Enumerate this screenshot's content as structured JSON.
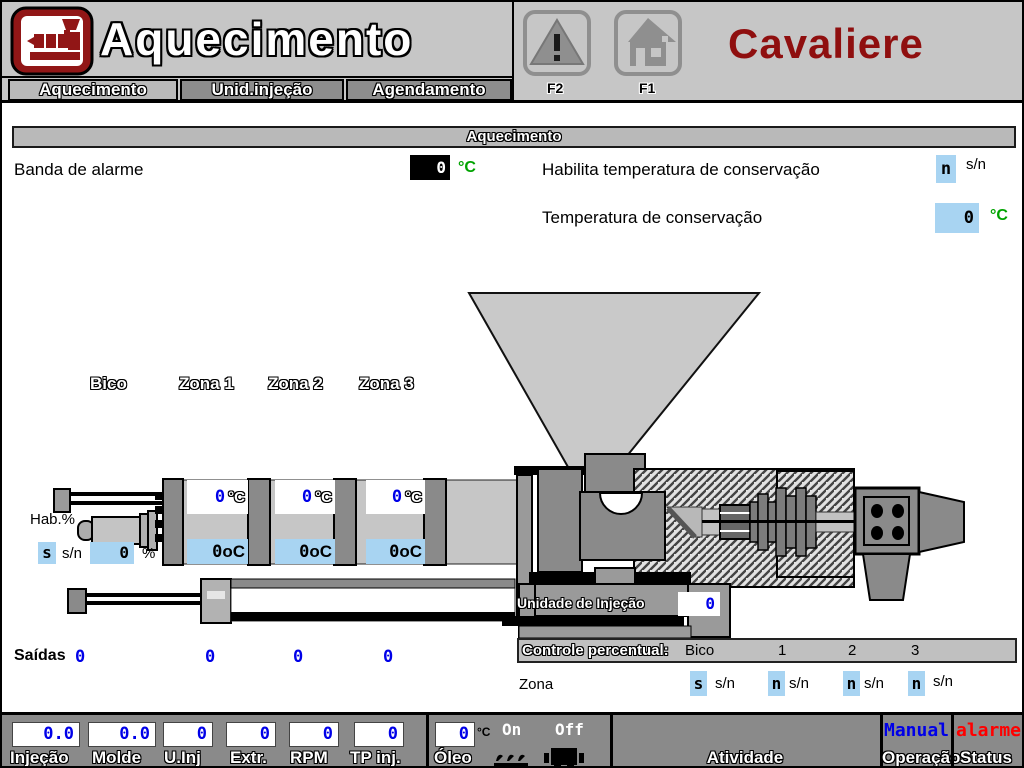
{
  "header": {
    "title": "Aquecimento",
    "brand": "Cavaliere",
    "fkeys": {
      "f2": "F2",
      "f1": "F1"
    }
  },
  "tabs": {
    "aquecimento": "Aquecimento",
    "unid_injecao": "Unid.injeção",
    "agendamento": "Agendamento"
  },
  "panel": {
    "title": "Aquecimento",
    "banda": {
      "label": "Banda de alarme",
      "value": "0",
      "unit": "°C"
    },
    "habilita": {
      "label": "Habilita temperatura de conservação",
      "value": "n",
      "unit": "s/n"
    },
    "conservacao": {
      "label": "Temperatura de conservação",
      "value": "0",
      "unit": "°C"
    }
  },
  "zones": {
    "labels": {
      "bico": "Bico",
      "z1": "Zona 1",
      "z2": "Zona 2",
      "z3": "Zona 3"
    },
    "setpoints": [
      {
        "value": "0",
        "unit": "°C"
      },
      {
        "value": "0",
        "unit": "°C"
      },
      {
        "value": "0",
        "unit": "°C"
      }
    ],
    "actuals": [
      {
        "value": "0",
        "unit": "oC"
      },
      {
        "value": "0",
        "unit": "oC"
      },
      {
        "value": "0",
        "unit": "oC"
      }
    ]
  },
  "hab": {
    "label": "Hab.%",
    "enable_value": "s",
    "enable_unit": "s/n",
    "percent_value": "0",
    "percent_unit": "%"
  },
  "unidade_injecao": {
    "label": "Unidade de Injeção",
    "value": "0"
  },
  "saidas": {
    "label": "Saídas",
    "values": [
      "0",
      "0",
      "0",
      "0"
    ]
  },
  "controle": {
    "title": "Controle percentual:",
    "col_bico": "Bico",
    "col_1": "1",
    "col_2": "2",
    "col_3": "3",
    "row_label": "Zona",
    "fields": [
      {
        "value": "s",
        "unit": "s/n"
      },
      {
        "value": "n",
        "unit": "s/n"
      },
      {
        "value": "n",
        "unit": "s/n"
      },
      {
        "value": "n",
        "unit": "s/n"
      }
    ]
  },
  "statusbar": {
    "fields": [
      {
        "label": "Injeção",
        "value": "0.0"
      },
      {
        "label": "Molde",
        "value": "0.0"
      },
      {
        "label": "U.Inj",
        "value": "0"
      },
      {
        "label": "Extr.",
        "value": "0"
      },
      {
        "label": "RPM",
        "value": "0"
      },
      {
        "label": "TP inj.",
        "value": "0"
      }
    ],
    "oleo": {
      "label": "Óleo",
      "value": "0",
      "unit": "°C",
      "on": "On",
      "off": "Off"
    },
    "atividade": "Atividade",
    "operacao": {
      "value": "Manual",
      "label": "Operação"
    },
    "status": {
      "value": "alarme",
      "label": "Status"
    }
  },
  "colors": {
    "brand_red": "#8f0f0f",
    "value_blue": "#0000e8",
    "field_blue": "#a8d4f2",
    "unit_green": "#00a300",
    "alarm_red": "#ff0000"
  }
}
